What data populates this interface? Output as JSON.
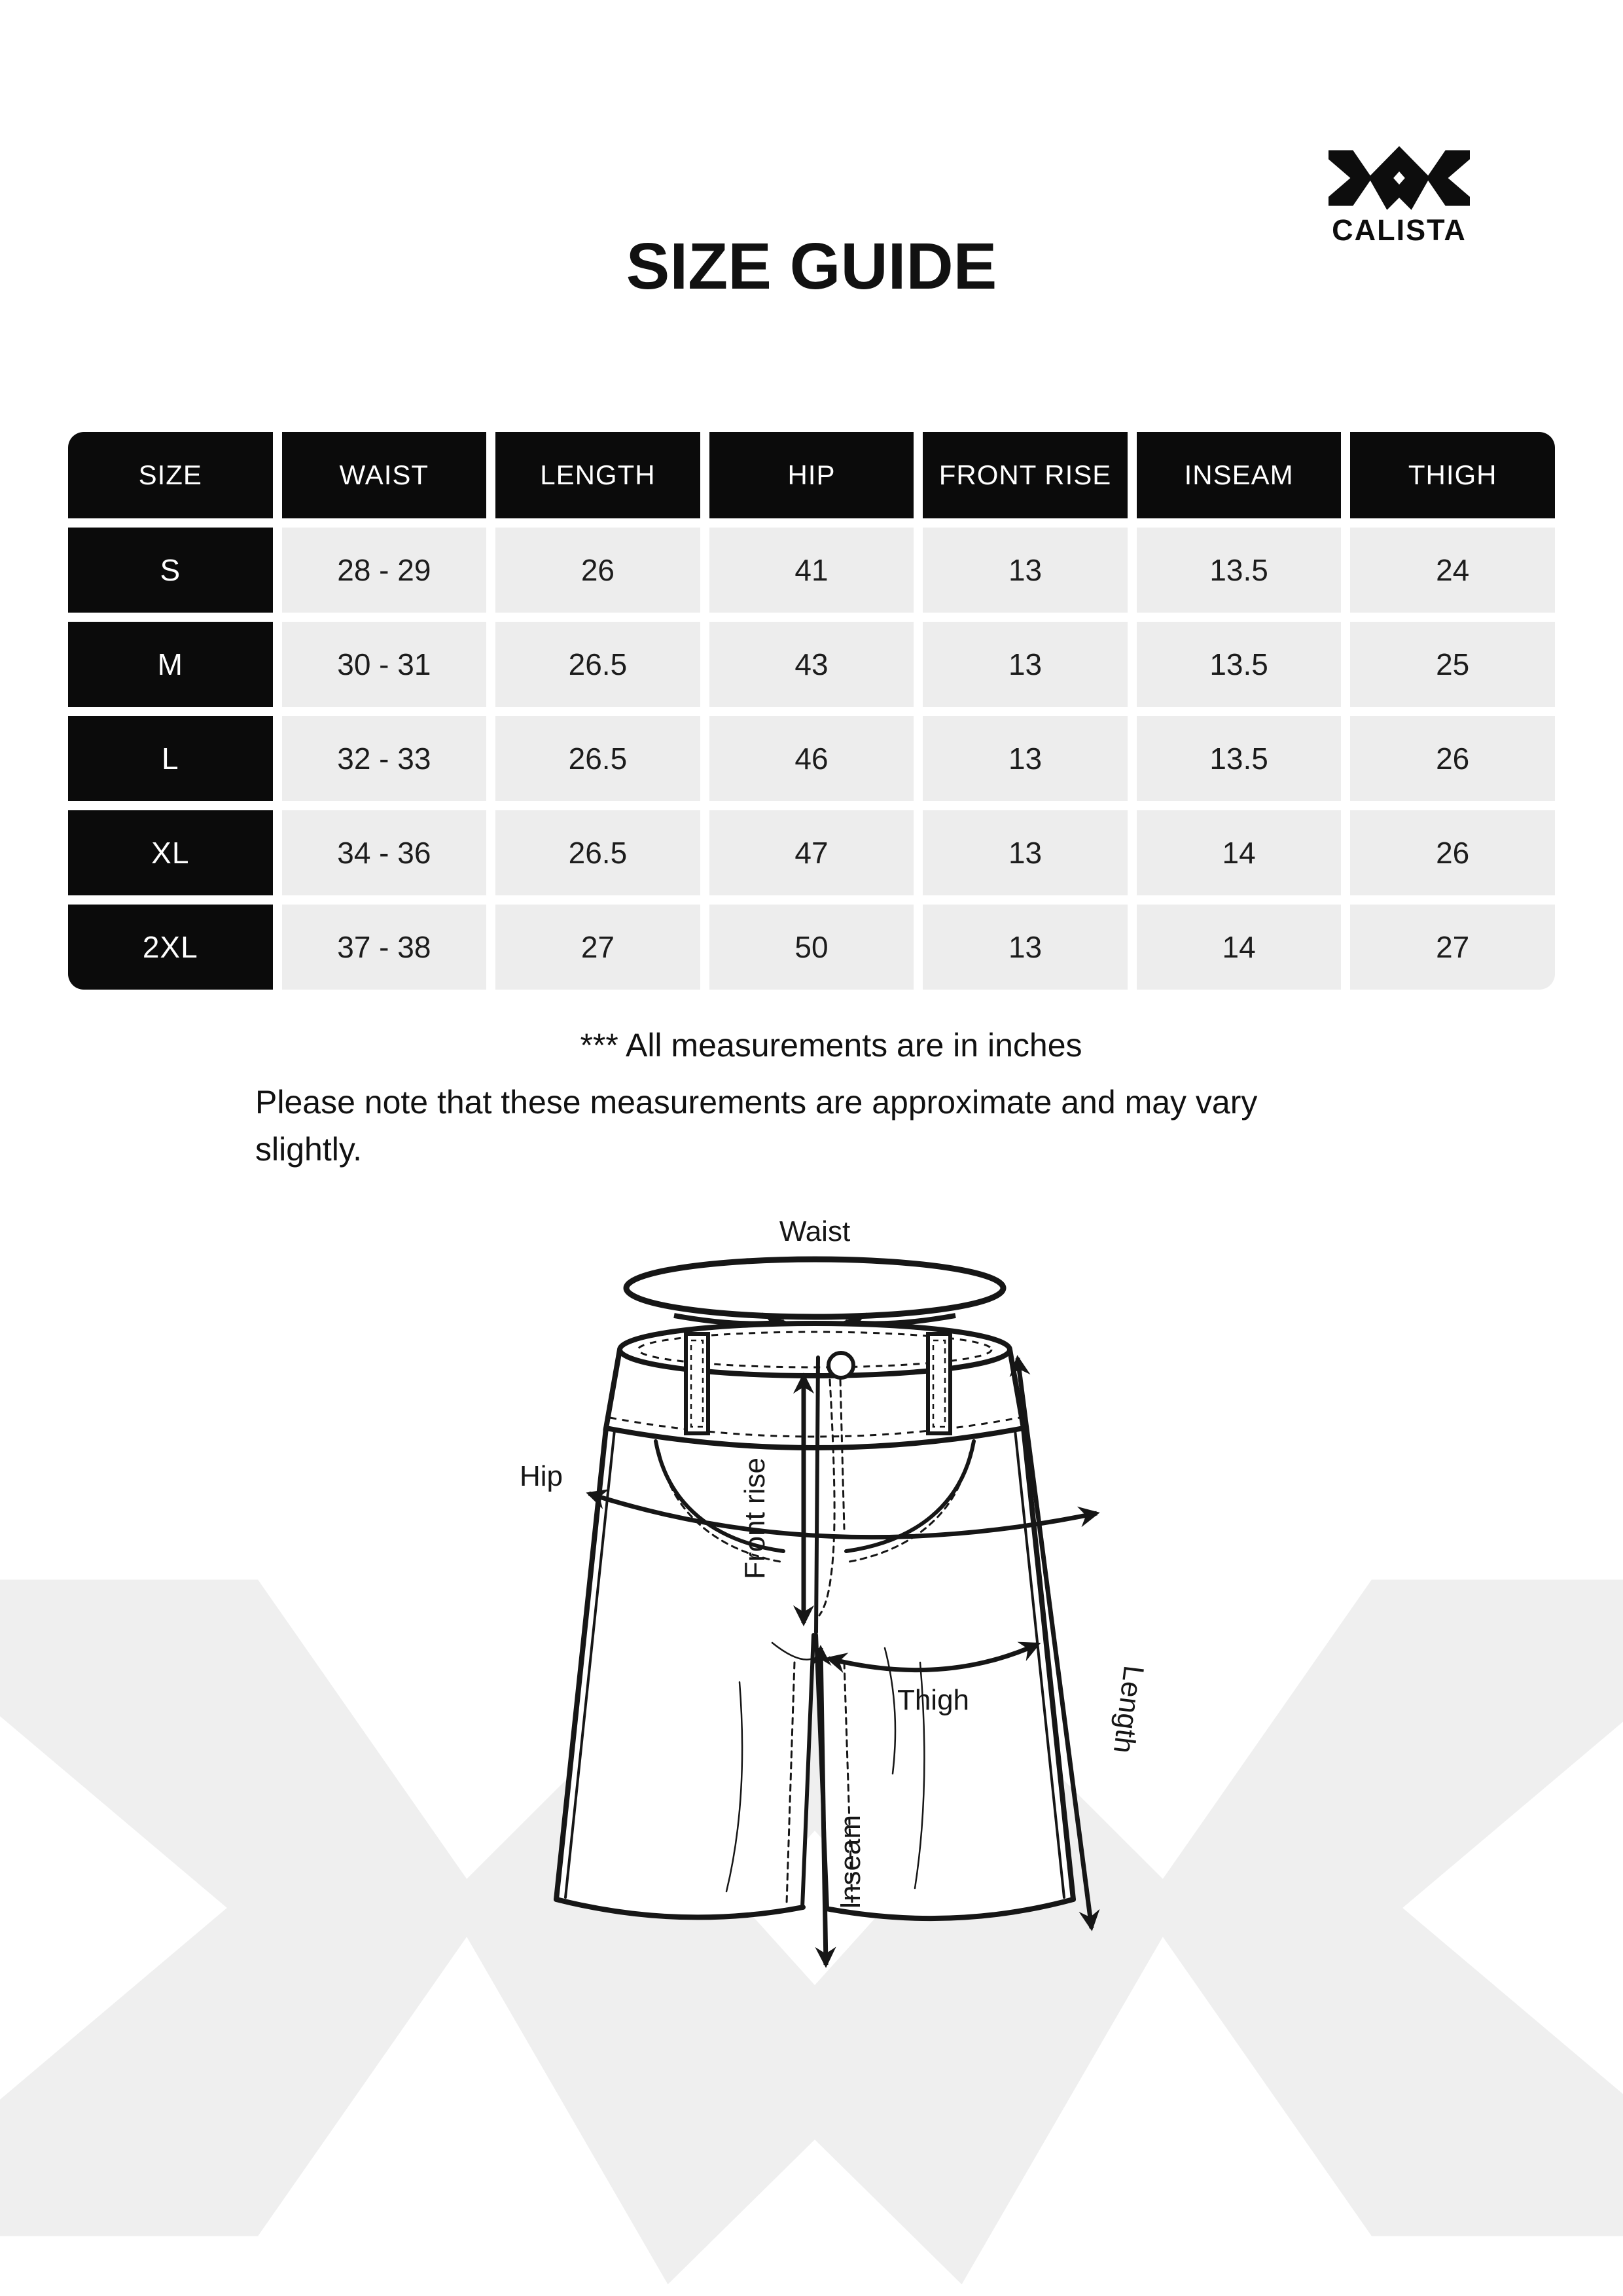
{
  "page": {
    "title": "SIZE GUIDE"
  },
  "brand": {
    "name": "CALISTA",
    "mark": "double-x-logo",
    "color": "#0d0d0d",
    "watermark_color": "#efefef"
  },
  "table": {
    "headers": [
      "SIZE",
      "WAIST",
      "LENGTH",
      "HIP",
      "FRONT RISE",
      "INSEAM",
      "THIGH"
    ],
    "rows": [
      {
        "size": "S",
        "values": [
          "28 - 29",
          "26",
          "41",
          "13",
          "13.5",
          "24"
        ]
      },
      {
        "size": "M",
        "values": [
          "30 - 31",
          "26.5",
          "43",
          "13",
          "13.5",
          "25"
        ]
      },
      {
        "size": "L",
        "values": [
          "32 - 33",
          "26.5",
          "46",
          "13",
          "13.5",
          "26"
        ]
      },
      {
        "size": "XL",
        "values": [
          "34 - 36",
          "26.5",
          "47",
          "13",
          "14",
          "26"
        ]
      },
      {
        "size": "2XL",
        "values": [
          "37 - 38",
          "27",
          "50",
          "13",
          "14",
          "27"
        ]
      }
    ],
    "header_bg": "#0b0b0b",
    "header_text": "#ffffff",
    "cell_bg": "#ededed",
    "cell_text": "#1c1c1c"
  },
  "notes": {
    "line1": "*** All measurements are in inches",
    "line2": "Please note that these measurements are approximate and may vary",
    "line3": "slightly."
  },
  "diagram": {
    "labels": {
      "waist": "Waist",
      "front_rise": "Front rise",
      "hip": "Hip",
      "thigh": "Thigh",
      "length": "Length",
      "inseam": "Inseam"
    }
  }
}
